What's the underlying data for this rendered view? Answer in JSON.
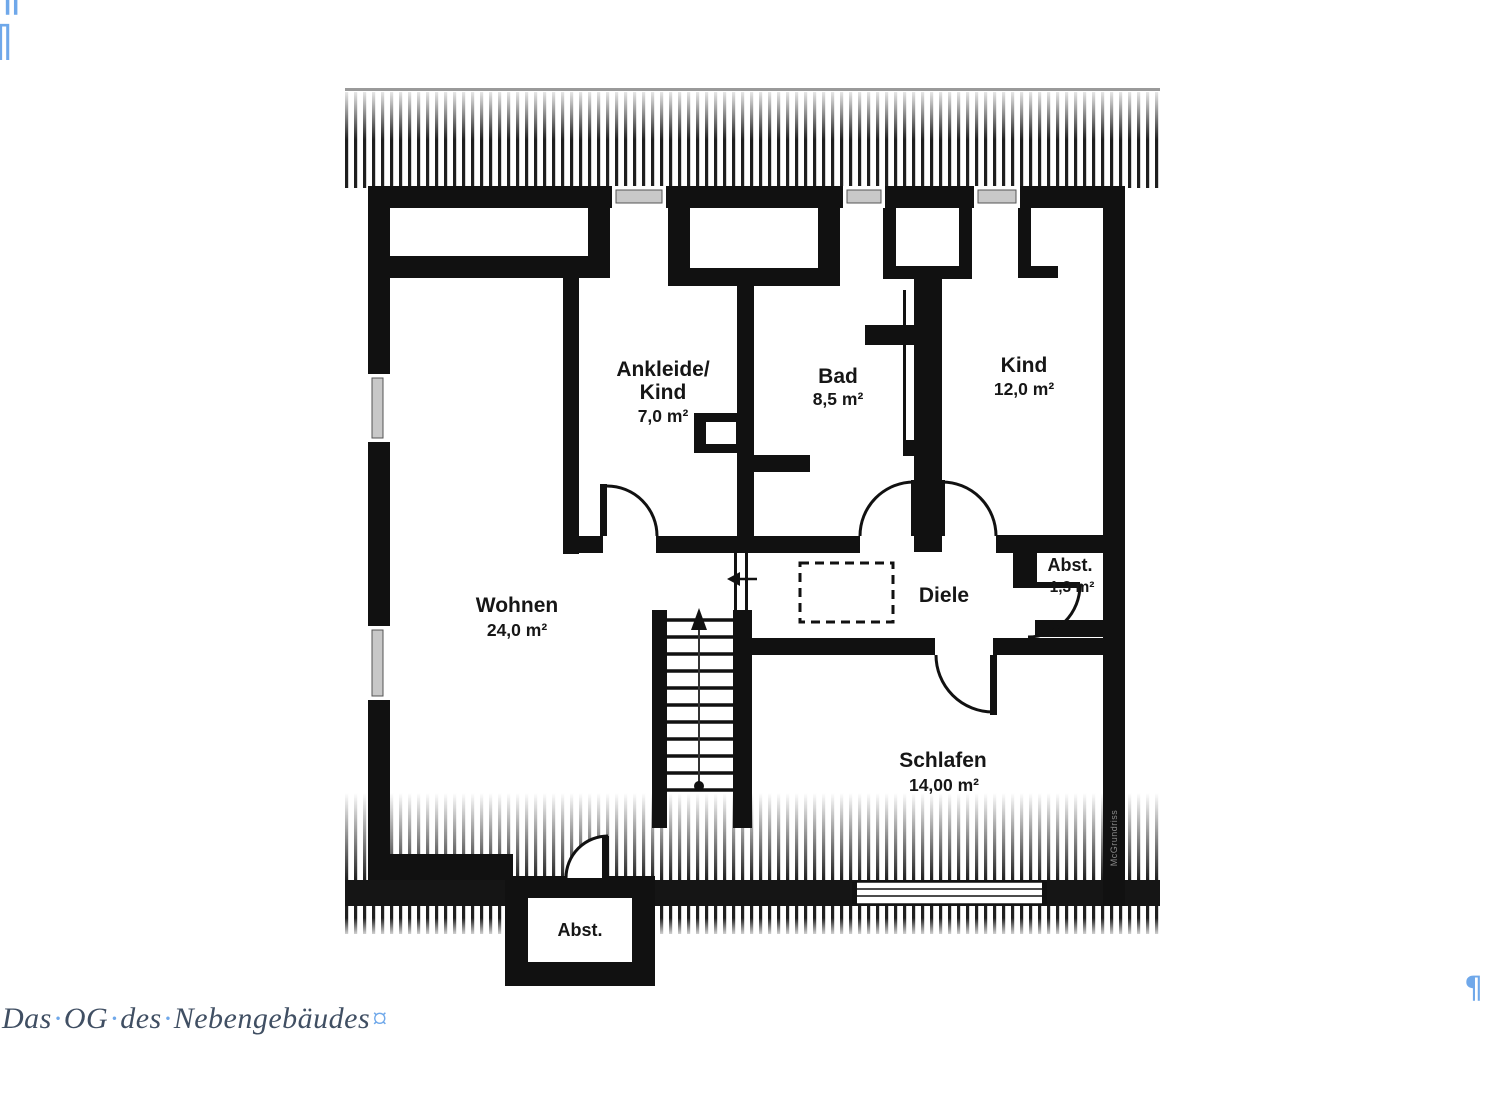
{
  "document": {
    "caption": {
      "words": [
        "Das",
        "OG",
        "des",
        "Nebengebäudes"
      ],
      "separator": "·",
      "end_mark": "¤"
    },
    "marks": {
      "pilcrow": "¶"
    }
  },
  "floorplan": {
    "watermark": "McGrundriss",
    "rooms": {
      "ankleide": {
        "name": "Ankleide/",
        "name2": "Kind",
        "area": "7,0 m²"
      },
      "bad": {
        "name": "Bad",
        "area": "8,5 m²"
      },
      "kind": {
        "name": "Kind",
        "area": "12,0 m²"
      },
      "wohnen": {
        "name": "Wohnen",
        "area": "24,0 m²"
      },
      "diele": {
        "name": "Diele"
      },
      "abstellraum_og": {
        "name": "Abst.",
        "area": "1,3 m²"
      },
      "schlafen": {
        "name": "Schlafen",
        "area": "14,00 m²"
      },
      "abstellraum_unten": {
        "name": "Abst."
      }
    },
    "colors": {
      "wall": "#111111",
      "window_fill": "#c8c8c8",
      "mark_blue": "#6fa8ea",
      "caption_text": "#404f63"
    }
  }
}
